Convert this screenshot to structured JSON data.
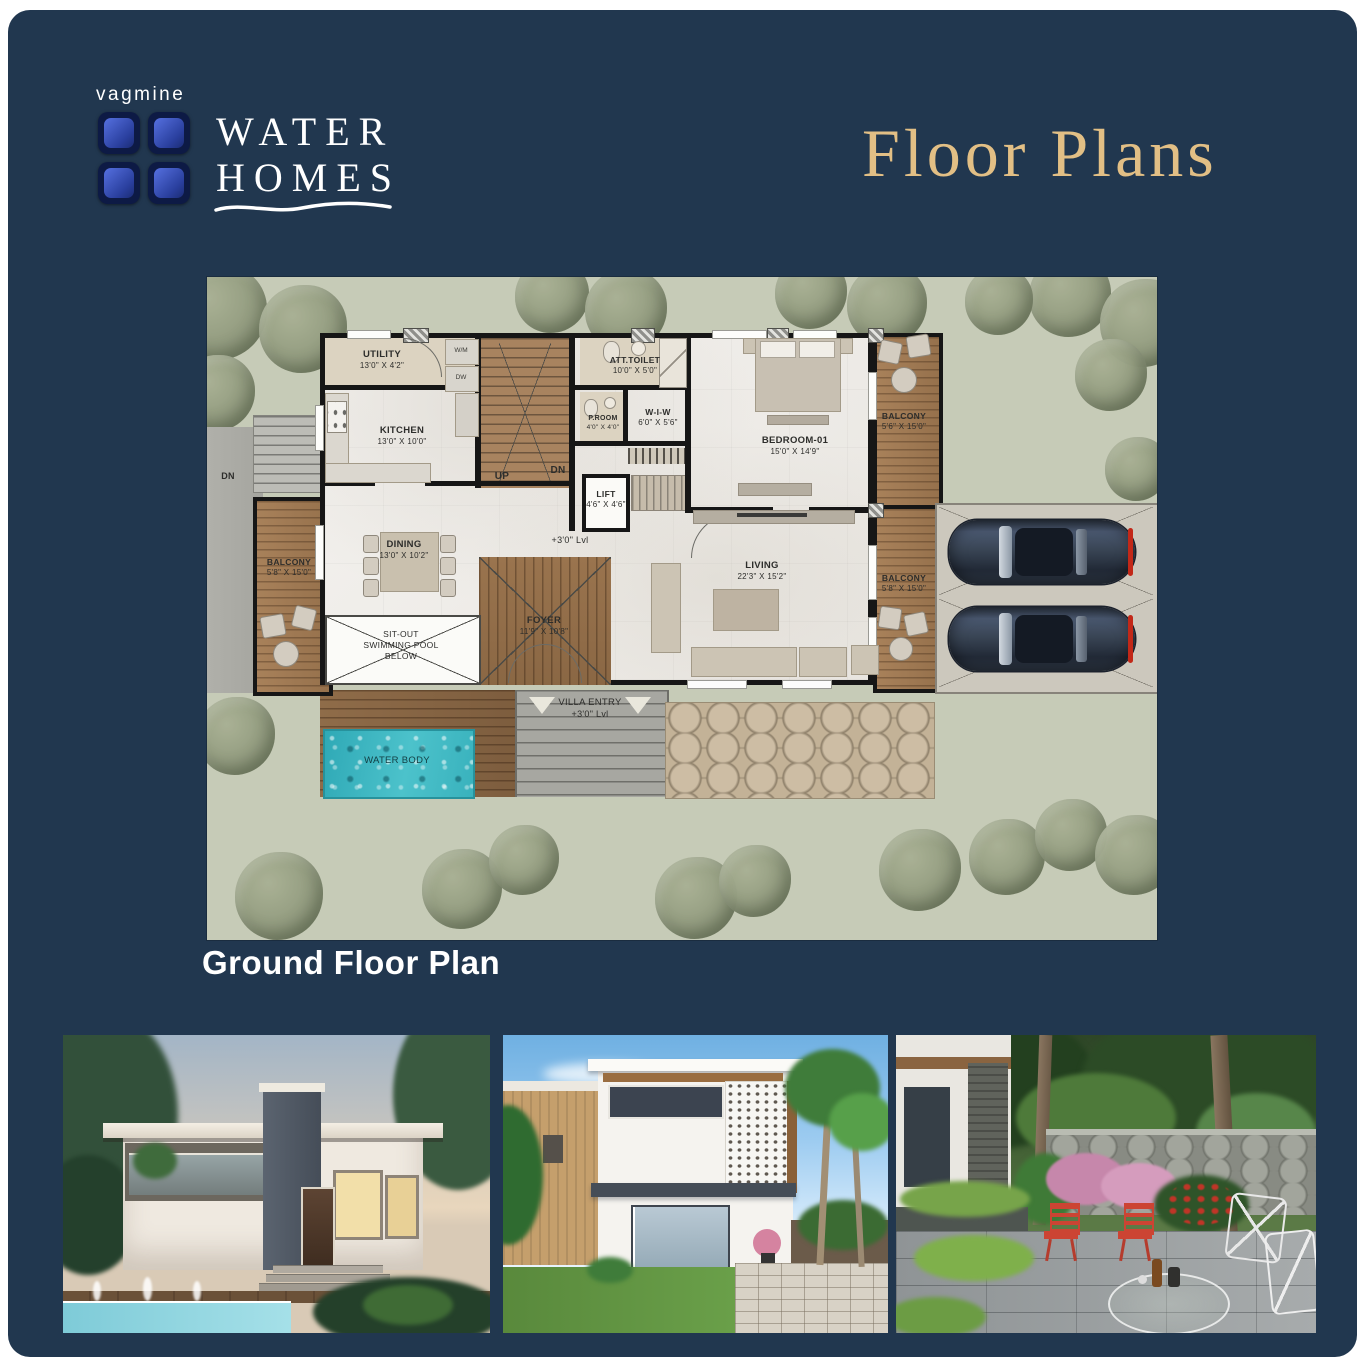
{
  "brand": {
    "wordmark": "vagmine",
    "line1": "WATER",
    "line2": "HOMES"
  },
  "title": "Floor Plans",
  "caption": "Ground Floor Plan",
  "colors": {
    "panel": "#21374F",
    "gold": "#E2BF85",
    "site_green": "#C6CBB7",
    "water": "#41B9C3"
  },
  "plan": {
    "rooms": [
      {
        "name": "UTILITY",
        "dims": "13'0\" X 4'2\""
      },
      {
        "name": "KITCHEN",
        "dims": "13'0\" X 10'0\""
      },
      {
        "name": "ATT.TOILET",
        "dims": "10'0\" X 5'0\""
      },
      {
        "name": "P.ROOM",
        "dims": "4'0\" X 4'0\""
      },
      {
        "name": "W-I-W",
        "dims": "6'0\" X 5'6\""
      },
      {
        "name": "LIFT",
        "dims": "4'6\" X 4'6\""
      },
      {
        "name": "BEDROOM-01",
        "dims": "15'0\" X 14'9\""
      },
      {
        "name": "BALCONY",
        "dims": "5'6\" X 15'0\""
      },
      {
        "name": "DINING",
        "dims": "13'0\" X 10'2\""
      },
      {
        "name": "FOYER",
        "dims": "11'9\" X 10'8\""
      },
      {
        "name": "LIVING",
        "dims": "22'3\" X 15'2\""
      },
      {
        "name": "BALCONY",
        "dims": "5'8\" X 15'0\""
      },
      {
        "name": "BALCONY",
        "dims": "5'8\" X 15'0\""
      }
    ],
    "labels": {
      "level": "+3'0\" Lvl",
      "up": "UP",
      "dn": "DN",
      "exterior_dn": "DN",
      "water_body": "WATER BODY",
      "wm": "W/M",
      "dw": "DW",
      "sitout_1": "SIT-OUT",
      "sitout_2": "SWIMMING POOL",
      "sitout_3": "BELOW",
      "entry_1": "VILLA ENTRY",
      "entry_2": "+3'0\" Lvl"
    }
  },
  "gallery": [
    {
      "name": "villa-exterior-dusk-pool-render"
    },
    {
      "name": "villa-exterior-day-render"
    },
    {
      "name": "villa-garden-courtyard-render"
    }
  ]
}
